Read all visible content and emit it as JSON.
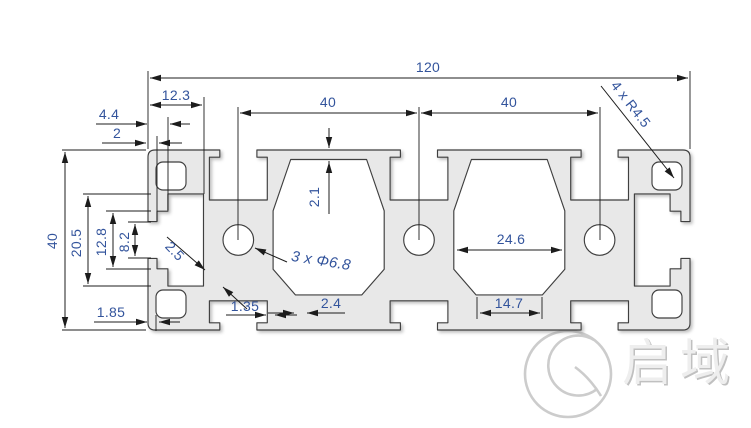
{
  "drawing": {
    "type": "aluminum-extrusion-profile-cross-section",
    "dimensions": {
      "overall_width": "120",
      "end_slot_depth": "12.3",
      "pitch_a": "40",
      "pitch_b": "40",
      "corner_note": "4 x R4.5",
      "end_tab": "4.4",
      "end_lip": "2",
      "overall_height": "40",
      "end_cavity_height": "20.5",
      "mid_cavity_height": "12.8",
      "slot_opening": "8.2",
      "diagonal_wall": "2.5",
      "bottom_lip": "1.85",
      "side_wall": "1.35",
      "web_wall": "2.4",
      "bay_clear_width": "24.6",
      "bottom_web_width": "14.7",
      "cap_thickness": "2.1",
      "hole_note": "3 x Φ6.8"
    },
    "watermark": {
      "text": "启域"
    },
    "colors": {
      "profile_fill": "#e8e8e8",
      "outline": "#3f3f3f",
      "dimension_line": "#1c1c1c",
      "dimension_text": "#33549c",
      "watermark_gray": "#cccccc",
      "background": "#ffffff"
    }
  }
}
